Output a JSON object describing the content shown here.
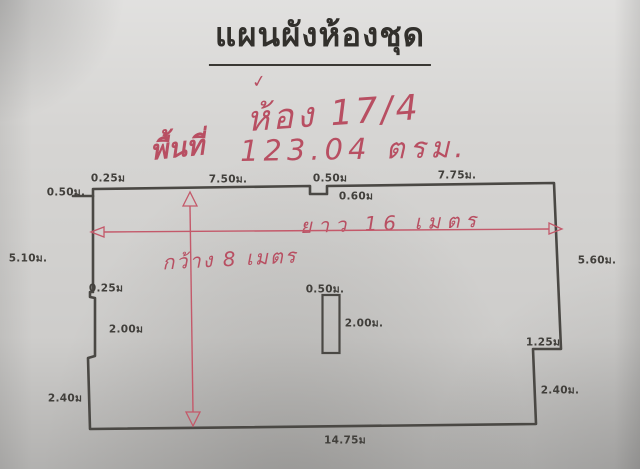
{
  "page": {
    "title": "แผนผังห้องชุด"
  },
  "red_annotations": {
    "checkmark": "✓",
    "room": "ห้อง 17/4",
    "area_label": "พื้นที่",
    "area_value": "123.04 ตรม.",
    "length_label": "ยาว 16 เมตร",
    "width_label": "กว้าง 8 เมตร"
  },
  "dimension_labels": [
    {
      "text": "0.50ม.",
      "x": 66,
      "y": 192
    },
    {
      "text": "0.25ม",
      "x": 108,
      "y": 178
    },
    {
      "text": "7.50ม.",
      "x": 228,
      "y": 179
    },
    {
      "text": "0.50ม",
      "x": 330,
      "y": 178
    },
    {
      "text": "0.60ม",
      "x": 356,
      "y": 196
    },
    {
      "text": "7.75ม.",
      "x": 457,
      "y": 175
    },
    {
      "text": "5.60ม.",
      "x": 597,
      "y": 260
    },
    {
      "text": "5.10ม.",
      "x": 28,
      "y": 258
    },
    {
      "text": "0.25ม",
      "x": 106,
      "y": 288
    },
    {
      "text": "2.00ม",
      "x": 126,
      "y": 329
    },
    {
      "text": "0.50ม.",
      "x": 325,
      "y": 289
    },
    {
      "text": "2.00ม.",
      "x": 364,
      "y": 323
    },
    {
      "text": "1.25ม",
      "x": 543,
      "y": 342
    },
    {
      "text": "2.40ม.",
      "x": 560,
      "y": 390
    },
    {
      "text": "2.40ม",
      "x": 65,
      "y": 398
    },
    {
      "text": "14.75ม",
      "x": 345,
      "y": 440
    }
  ],
  "colors": {
    "paper": "#d6d5d3",
    "ink": "#4a4844",
    "red_marker": "#b84f62",
    "red_line": "#c4596a"
  }
}
